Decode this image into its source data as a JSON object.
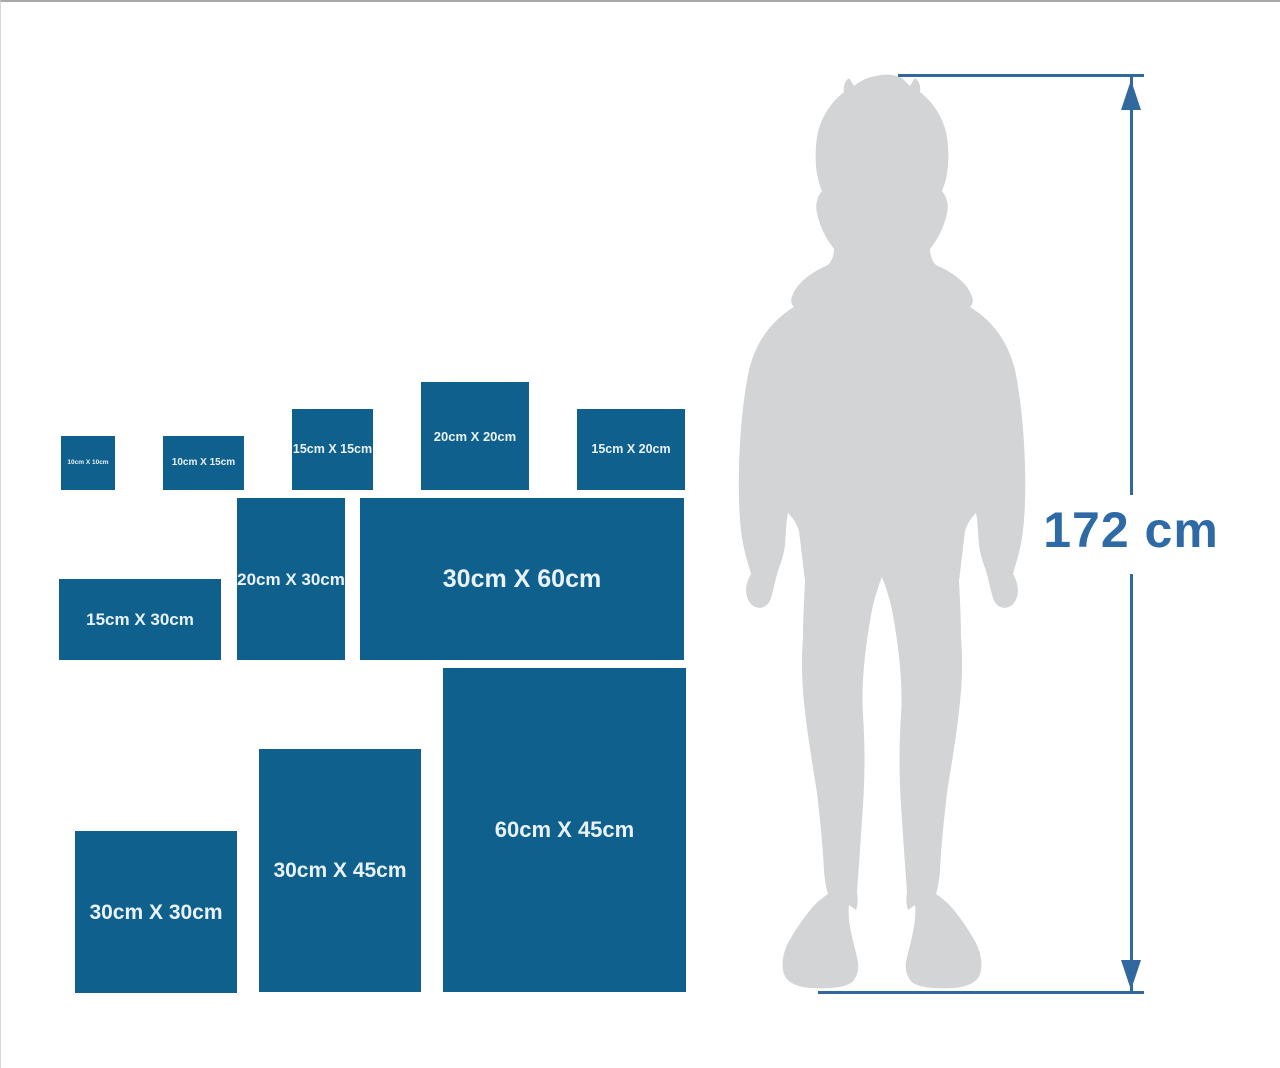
{
  "figure": {
    "height_label": "172 cm"
  },
  "sizes": [
    {
      "label": "10cm X 10cm",
      "size_cm": "10 x 10",
      "render_w_cm": 10,
      "render_h_cm": 10
    },
    {
      "label": "10cm X 15cm",
      "size_cm": "10 x 15",
      "render_w_cm": 15,
      "render_h_cm": 10
    },
    {
      "label": "15cm X 15cm",
      "size_cm": "15 x 15",
      "render_w_cm": 15,
      "render_h_cm": 15
    },
    {
      "label": "20cm X 20cm",
      "size_cm": "20 x 20",
      "render_w_cm": 20,
      "render_h_cm": 20
    },
    {
      "label": "15cm X 20cm",
      "size_cm": "15 x 20",
      "render_w_cm": 20,
      "render_h_cm": 15
    },
    {
      "label": "15cm X 30cm",
      "size_cm": "15 x 30",
      "render_w_cm": 30,
      "render_h_cm": 15
    },
    {
      "label": "20cm X 30cm",
      "size_cm": "20 x 30",
      "render_w_cm": 20,
      "render_h_cm": 30
    },
    {
      "label": "30cm X 60cm",
      "size_cm": "30 x 60",
      "render_w_cm": 60,
      "render_h_cm": 30
    },
    {
      "label": "30cm X 30cm",
      "size_cm": "30 x 30",
      "render_w_cm": 30,
      "render_h_cm": 30
    },
    {
      "label": "30cm X 45cm",
      "size_cm": "30 x 45",
      "render_w_cm": 30,
      "render_h_cm": 45
    },
    {
      "label": "60cm X 45cm",
      "size_cm": "60 x 45",
      "render_w_cm": 45,
      "render_h_cm": 60
    }
  ],
  "colors": {
    "panel_blue": "#10608d",
    "panel_label": "#e9f2f6",
    "measure_blue": "#31699e",
    "height_text_blue": "#2e6ba6",
    "silhouette_gray": "#d2d4d5",
    "background": "#ffffff"
  }
}
